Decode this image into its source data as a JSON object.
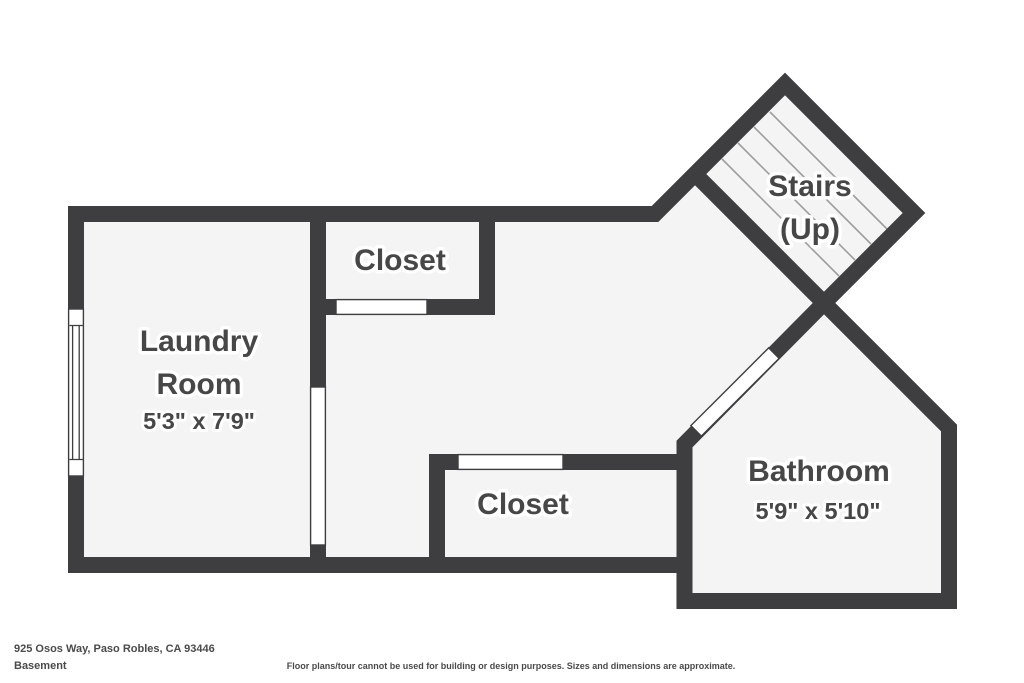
{
  "floorplan": {
    "address": "925 Osos Way, Paso Robles, CA 93446",
    "level": "Basement",
    "disclaimer": "Floor plans/tour cannot be used for building or design purposes. Sizes and dimensions are approximate.",
    "colors": {
      "bg": "#ffffff",
      "floor": "#f4f4f5",
      "wall": "#3e3e40",
      "tread": "#9e9e9e",
      "label": "#474747",
      "footer": "#4a4a4a"
    },
    "rooms": [
      {
        "id": "laundry-room",
        "lines": [
          "Laundry",
          "Room"
        ],
        "dimensions": "5'3\" x 7'9\""
      },
      {
        "id": "closet-top",
        "lines": [
          "Closet"
        ]
      },
      {
        "id": "closet-bottom",
        "lines": [
          "Closet"
        ]
      },
      {
        "id": "stairs",
        "lines": [
          "Stairs",
          "(Up)"
        ]
      },
      {
        "id": "bathroom",
        "lines": [
          "Bathroom"
        ],
        "dimensions": "5'9\" x 5'10\""
      }
    ]
  }
}
